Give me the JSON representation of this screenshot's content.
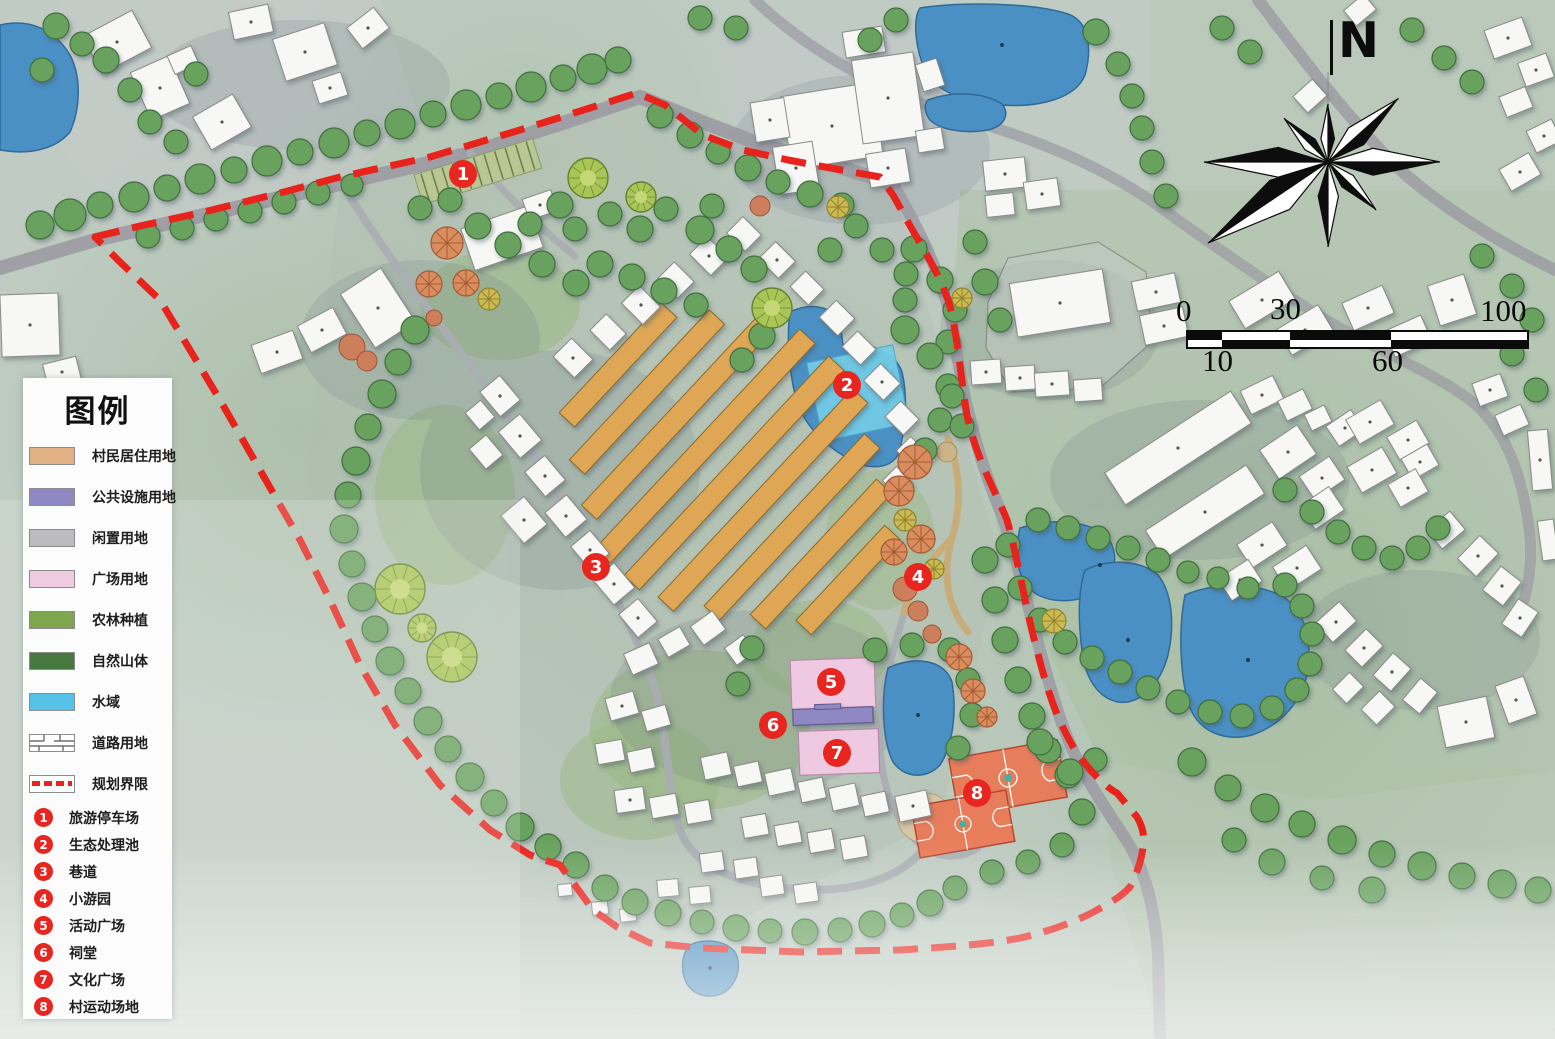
{
  "map": {
    "north_label": "N",
    "scale_bar": {
      "top_labels": [
        "0",
        "30",
        "100"
      ],
      "bottom_labels": [
        "10",
        "60"
      ]
    }
  },
  "legend": {
    "title": "图例",
    "items": [
      {
        "label": "村民居住用地",
        "color": "#e2b183",
        "kind": "fill"
      },
      {
        "label": "公共设施用地",
        "color": "#8f88c2",
        "kind": "fill"
      },
      {
        "label": "闲置用地",
        "color": "#bcbcbe",
        "kind": "fill"
      },
      {
        "label": "广场用地",
        "color": "#efcbe0",
        "kind": "fill"
      },
      {
        "label": "农林种植",
        "color": "#7da64f",
        "kind": "fill"
      },
      {
        "label": "自然山体",
        "color": "#47793e",
        "kind": "fill"
      },
      {
        "label": "水域",
        "color": "#55c3e8",
        "kind": "fill"
      },
      {
        "label": "道路用地",
        "color": "#ffffff",
        "kind": "road"
      },
      {
        "label": "规划界限",
        "color": "#e8231c",
        "kind": "dash"
      }
    ],
    "numbered": [
      {
        "num": "1",
        "label": "旅游停车场"
      },
      {
        "num": "2",
        "label": "生态处理池"
      },
      {
        "num": "3",
        "label": "巷道"
      },
      {
        "num": "4",
        "label": "小游园"
      },
      {
        "num": "5",
        "label": "活动广场"
      },
      {
        "num": "6",
        "label": "祠堂"
      },
      {
        "num": "7",
        "label": "文化广场"
      },
      {
        "num": "8",
        "label": "村运动场地"
      }
    ]
  },
  "colors": {
    "boundary_red": "#e8231c",
    "marker_red": "#e8251f",
    "pond_blue": "#4b90c4",
    "treatment_pool_cyan": "#74cde8",
    "residential_row_orange": "#dfa755",
    "court_orange": "#e87d5c",
    "building_white": "#f7f7f5",
    "road_gray": "#9b9aa2",
    "tree_green": "#69a15e"
  }
}
